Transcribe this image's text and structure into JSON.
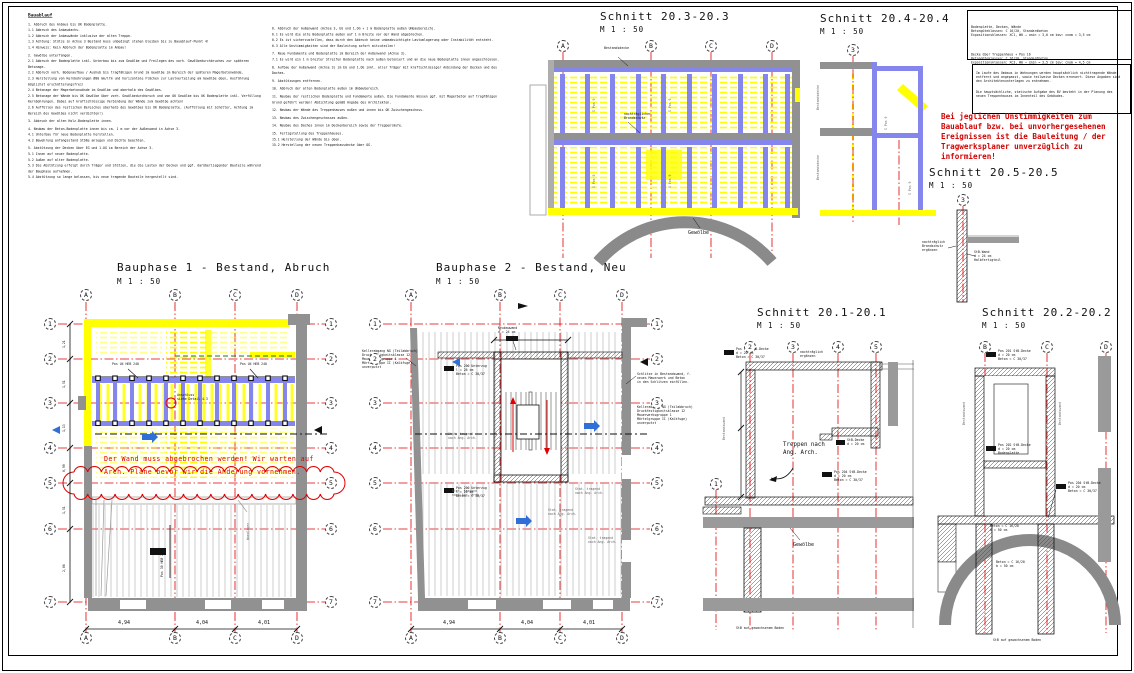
{
  "colors": {
    "demolition_yellow": "#ffff00",
    "new_steel_blue": "#8585ee",
    "grid_line_red": "#e00000",
    "existing_wall_gray": "#919191",
    "annotation_red": "#e00000",
    "green_dashed": "#1a7a1a",
    "arrow_blue": "#2f6fd6"
  },
  "notes_left": {
    "title": "Bauablauf",
    "items": [
      "1. Abbruch des Anbaus bis OK Bodenplatte.",
      "1.1 Abbruch des Anbaudachs.",
      "1.2 Abbruch der Anbauwände inklusive der alten Treppe.",
      "1.3 Achtung: Stütze in Achse 3 Bestand muss unbedingt stehen bleiben bis zu Bauablauf-Punkt 4!",
      "1.4 Hinweis: Kein Abbruch der Bodenplatte im Anbau!",
      "",
      "2. Gewölbe unterfangen.",
      "2.1 Abbruch der Bodenplatte inkl. Unterbau bis zum Gewölbe und Freilegen des vorh. Gewölbedurchbruches zur späteren Betonage.",
      "2.2 Abbruch vorh. Bodenaufbau / Aushub bis tragfähigen Grund im Gewölbe im Bereich der späteren Magerbetonwände.",
      "2.3 Herstellung von Kernbohrungen Ø80 mm/lfm und horizontale Flächen zur Lastverteilung am Gewölbe oben, Ausführung möglichst erschütterungsfrei!",
      "2.4 Betonage der Magerbetonwände im Gewölbe und oberhalb des Gewölbes.",
      "2.5 Betonage der Wände bis UK Gewölbe über vorh. Gewölbedurchbruch und von OK Gewölbe bis UK Bodenplatte inkl. Verfüllung Kernbohrungen. Dabei auf kraftschlüssige Verbindung der Wände zum Gewölbe achten!",
      "2.6 Auffüllen des restlichen Bereiches oberhalb des Gewölbes bis UK Bodenplatte. (Auffüllung mit Schotter, Achtung im Bereich des Gewölbes nicht verdichten!)",
      "",
      "3. Abbruch der alten Holz-Bodenplatte innen.",
      "",
      "4. Neubau der Beton-Bodenplatte innen bis ca. 1 m vor der Außenwand in Achse 3.",
      "4.1 Unterbau für neue Bodenplatte herstellen.",
      "4.2 Bewehrung anfangsstand Stöße anlegen und Dichte beachten.",
      "",
      "5. Abstützung der Decken über EG und 1.OG im Bereich der Achse 3.",
      "5.1 Innen auf neuer Bodenplatte.",
      "5.2 Außen auf alter Bodenplatte.",
      "5.3 Die Abstützung erfolgt durch Träger und Stützen, die die Lasten der Decken und ggf. darüberliegender Bauteile während der Bauphase aufnehmen.",
      "5.4 Abstützung so lange belassen, bis neue tragende Bauteile hergestellt sind."
    ]
  },
  "notes_right": {
    "items": [
      "6. Abbruch der Außenwand (Achse 3, EG und 1.OG + 1 m Bodenplatte außen Umbaubereich).",
      "6.1 Es wird die alte Bodenplatte außen auf 1 m Breite vor der Wand abgebrochen.",
      "6.2 Es ist sicherzustellen, dass durch den Abbruch keine unbeabsichtigte Lastumlagerung oder Instabilität entsteht.",
      "6.3 Alle Unstimmigkeiten sind der Bauleitung sofort mitzuteilen!",
      "",
      "7. Neue Fundamente und Bodenplatte im Bereich der Außenwand (Achse 3).",
      "7.1 Es wird ein 1 m breiter Streifen Bodenplatte nach außen betoniert und an die neue Bodenplatte innen angeschlossen.",
      "",
      "8. Aufbau der Außenwand (Achse 3) im EG und 1.OG inkl. aller Träger mit kraftschlüssiger Anbindung der Decken und des Daches.",
      "",
      "9. Abstützungen entfernen.",
      "",
      "10. Abbruch der alten Bodenplatte außen im Umbaubereich.",
      "",
      "11. Neubau der restlichen Bodenplatte und Fundamente außen. Die Fundamente müssen ggf. mit Magerbeton auf tragfähigen Grund geführt werden! Abdichtung gemäß Angabe des Architekten.",
      "",
      "12. Neubau der Wände des Treppenhauses außen und innen bis OK Zwischengeschoss.",
      "",
      "13. Neubau des Zwischengeschosses außen.",
      "",
      "14. Neubau des Daches innen im Deckenbereich sowie der Treppenläufe.",
      "",
      "15. Fertigstellung des Treppenhauses.",
      "15.1 Herstellung der Wände bis oben.",
      "15.2 Herstellung der neuen Treppenhausdecke über OG."
    ]
  },
  "spec_box": {
    "group1": [
      "Bodenplatte, Decken, Wände",
      "Betongüteklassen:  C 16/20, Standardbeton",
      "Expositionsklassen:  XC1, W0 →  cmin = 3,0 cm        bzw: cnom = 3,5 cm"
    ],
    "group2": [
      "Decke über Treppenhaus + Pos 16",
      "Betongüteklassen:  C 16/20, Standardbeton",
      "Expositionsklassen:  XC3, W0 →  cmin = 3,5 cm        bzw: cnom = 4,5 cm"
    ]
  },
  "info_box": {
    "para1": "Im Laufe des Umbaus in Wohnungen werden hauptsächlich nichttragende Wände entfernt und angepasst, sowie teilweise Decken erneuert. Diese Angaben sind den Architektenunterlagen zu entnehmen.",
    "para2": "Die hauptsächliche, statische Aufgabe des BV besteht in der Planung des neuen Treppenhauses im Innenteil des Gebäudes."
  },
  "warning": "Bei jeglichen Unstimmigkeiten zum Bauablauf bzw. bei unvorhergesehenen Ereignissen ist die Bauleitung / der Tragwerksplaner unverzüglich zu informieren!",
  "shared": {
    "gewoelbe": "Gewölbe",
    "boden": "StB auf gewachsenem Boden"
  },
  "views": {
    "schnitt203": {
      "title": "Schnitt 20.3-20.3",
      "scale": "M 1 : 50",
      "grid": [
        "A",
        "B",
        "C",
        "D"
      ],
      "labels": {
        "bestandsdecke": "Bestandsdecke",
        "brandschutz": "nachträglicher\nBrandschutz",
        "spos": "S Pos 9"
      }
    },
    "schnitt204": {
      "title": "Schnitt 20.4-20.4",
      "scale": "M 1 : 50",
      "grid": [
        "3"
      ],
      "labels": {
        "bestandsdecke": "Bestandsdecke"
      }
    },
    "schnitt205": {
      "title": "Schnitt 20.5-20.5",
      "scale": "M 1 : 50",
      "grid": [
        "3"
      ],
      "labels": {
        "links": "nachträglich\nBrandschutz\nergänzen",
        "rechts": "StB-Wand\nd = 24 cm\nHalbfertigteil"
      }
    },
    "bauphase1": {
      "title": "Bauphase 1 - Bestand, Abruch",
      "scale": "M 1 : 50",
      "grid_cols": [
        "A",
        "B",
        "C",
        "D"
      ],
      "grid_rows": [
        "1",
        "2",
        "3",
        "4",
        "5",
        "6",
        "7"
      ],
      "note_red": "Der Wand muss abgebrochen werden! Wir warten auf\nArch. Pläne bevor wir die Änderung vornehmen.",
      "beam_label": "Pos U4  HEB 240",
      "detail_label": "Anschluss\nsiehe Detail 4.3",
      "wandlager": "Wandlager",
      "pos_block": "Pos 30  HEB 240",
      "dims_bottom": [
        "4,94",
        "4,04",
        "4,01"
      ],
      "dims_left": [
        "1,21",
        "1,51",
        "1,13",
        "0,99",
        "1,51",
        "2,06"
      ]
    },
    "bauphase2": {
      "title": "Bauphase 2 - Bestand, Neu",
      "scale": "M 1 : 50",
      "grid_cols": [
        "A",
        "B",
        "C",
        "D"
      ],
      "grid_rows": [
        "1",
        "2",
        "3",
        "4",
        "5",
        "6",
        "7"
      ],
      "ann_left": "Kellerabgang NG (Teilabbruch)\nDruckfestigkeitsklasse 12\nMauerwerksgruppe 1\nMörtelgruppe II (Kalkfuge)\nunverputzt",
      "ann_right": "Schlitze in Bestandswand, f.\nneues Mauerwerk und Beton\nin den Schlitzen einfüllen.",
      "stat_label": "Stat. tragend\nnach Ang. Arch.",
      "pos200": "Pos 200 Unterzug\nl = 26 cm\nBeton = C 30/37",
      "neubauwand": "Neubauwand\nd = 24 cm",
      "dims_bottom": [
        "4,94",
        "4,04",
        "4,01"
      ]
    },
    "schnitt201": {
      "title": "Schnitt 20.1-20.1",
      "scale": "M 1 : 50",
      "grid_top": [
        "2",
        "3",
        "4",
        "5"
      ],
      "grid_left": [
        "1"
      ],
      "treppen": "Treppen nach\nAng. Arch.",
      "pos201": "Pos 201 StB-Decke\nd = 20 cm\nBeton = C 30/37",
      "nachtraeglich": "nachträglich\nergänzen",
      "stb20": "StB-Decke\nd = 20 cm",
      "pos204": "Pos 204 StB-Decke\nd = 20 cm\nBeton = C 30/37",
      "bestandswand": "Bestandswand"
    },
    "schnitt202": {
      "title": "Schnitt 20.2-20.2",
      "scale": "M 1 : 50",
      "grid_top": [
        "B",
        "C",
        "D"
      ],
      "pos202": "Pos 202 StB-Decke\nd = 20 cm\nBodenplatte",
      "beton": "Beton = C 16/20\nb = 50 cm"
    }
  }
}
